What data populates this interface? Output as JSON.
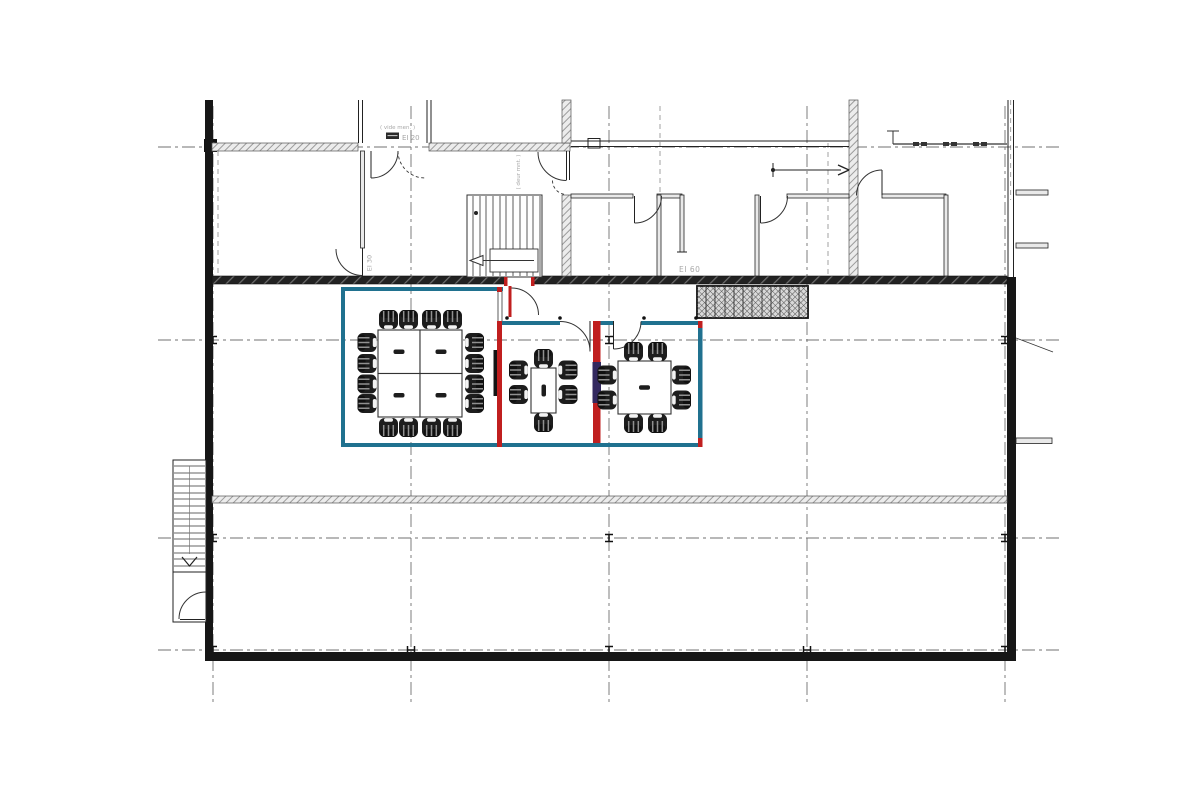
{
  "labels": {
    "vide_note": "( vide men. )",
    "ei20": "EI 20",
    "deur_note": "( deur mnt. )",
    "ei30": "EI 30",
    "ei60": "EI 60"
  },
  "colors": {
    "wall_teal": "#20718f",
    "wall_red": "#c01f1f",
    "panel_purple": "#33295f",
    "wall_dark": "#1c1c1c",
    "grid_gray": "#707070",
    "label_gray": "#a8a8a8",
    "chair_dark": "#1d1d1d"
  },
  "rooms": [
    {
      "id": "meeting-room-1",
      "tables": 4,
      "chairs": 16
    },
    {
      "id": "meeting-room-2",
      "tables": 1,
      "chairs": 6
    },
    {
      "id": "meeting-room-3",
      "tables": 1,
      "chairs": 8
    }
  ],
  "grid": {
    "vertical_axes": 5,
    "horizontal_axes": 4
  }
}
